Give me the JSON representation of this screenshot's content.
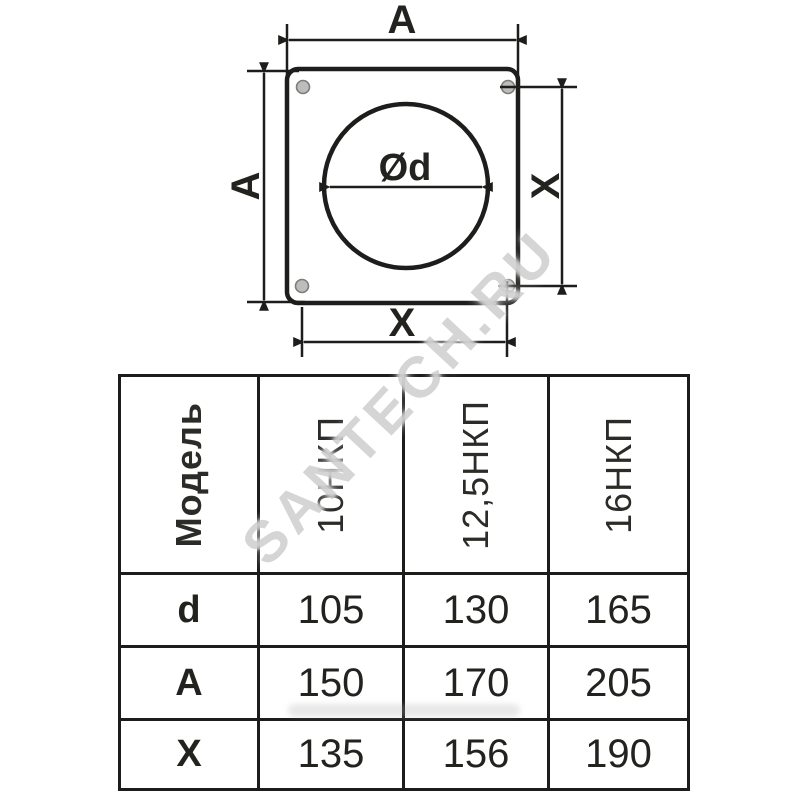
{
  "diagram": {
    "top_dim_label": "A",
    "left_dim_label": "A",
    "right_dim_label": "X",
    "bottom_dim_label": "X",
    "diameter_label": "Ød"
  },
  "watermark": {
    "text": "SANTECH.RU"
  },
  "table": {
    "header": {
      "model_label": "Модель",
      "columns": [
        "10НКП",
        "12,5НКП",
        "16НКП"
      ]
    },
    "rows": [
      {
        "label": "d",
        "values": [
          "105",
          "130",
          "165"
        ]
      },
      {
        "label": "A",
        "values": [
          "150",
          "170",
          "205"
        ]
      },
      {
        "label": "X",
        "values": [
          "135",
          "156",
          "190"
        ]
      }
    ]
  },
  "colors": {
    "line": "#1d1d1b",
    "watermark": "#9c9c9c"
  }
}
